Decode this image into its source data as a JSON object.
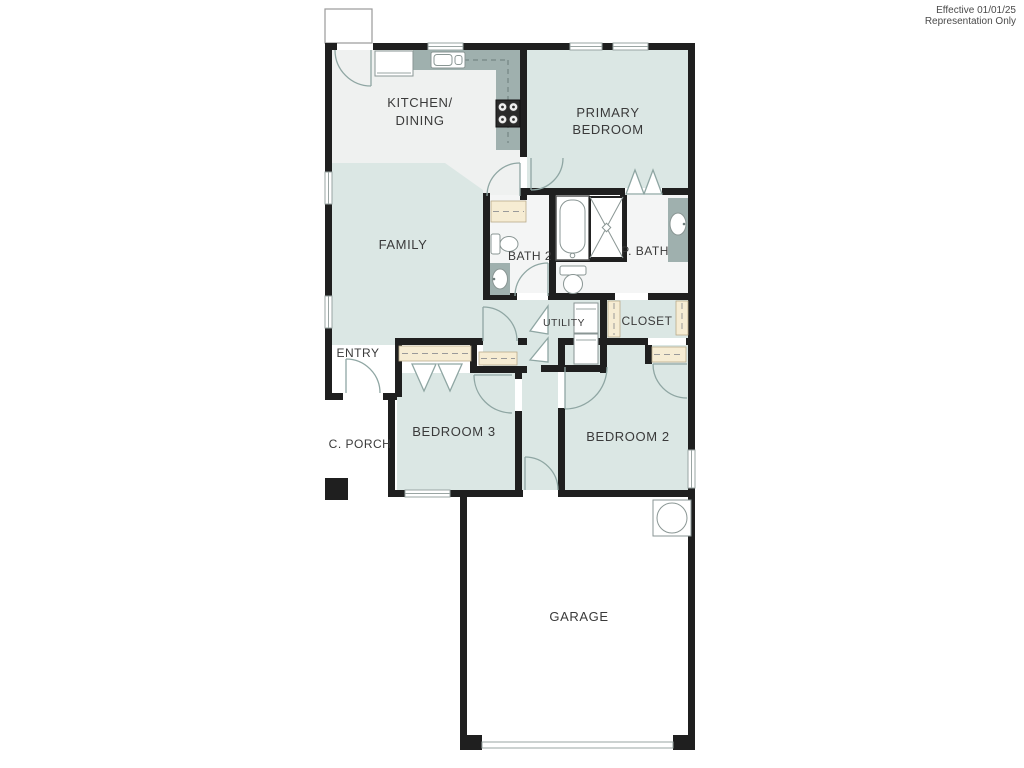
{
  "annotation": {
    "line1": "Effective 01/01/25",
    "line2": "Representation Only"
  },
  "rooms": {
    "kitchen_line1": "KITCHEN/",
    "kitchen_line2": "DINING",
    "primary_line1": "PRIMARY",
    "primary_line2": "BEDROOM",
    "family": "FAMILY",
    "bath2": "BATH 2",
    "pbath": "P. BATH",
    "utility": "UTILITY",
    "closet": "CLOSET",
    "entry": "ENTRY",
    "porch": "C. PORCH",
    "bedroom3": "BEDROOM 3",
    "bedroom2": "BEDROOM 2",
    "garage": "GARAGE"
  },
  "fixtures": {
    "list": [
      "refrigerator",
      "kitchen-sink",
      "stove",
      "bathtub",
      "shower",
      "toilet-bath2",
      "vanity-sink-bath2",
      "toilet-pbath",
      "vanity-sink-pbath",
      "washer-dryer",
      "water-heater",
      "linen-shelf",
      "closet-shelves",
      "garage-door",
      "stoop",
      "porch-post"
    ]
  },
  "colors": {
    "wall": "#1f1f1f",
    "room-green": "#dbe7e4",
    "floor-light": "#eff1f0",
    "floor-bath": "#f4f5f5",
    "counter": "#9fb0ae",
    "shelf": "#f6ecd3",
    "shelf-edge": "#b9ab8a",
    "door-line": "#8fa6a3",
    "fixture-line": "#8a9694",
    "text": "#3a3a3a",
    "annotation": "#4a4a4a"
  }
}
